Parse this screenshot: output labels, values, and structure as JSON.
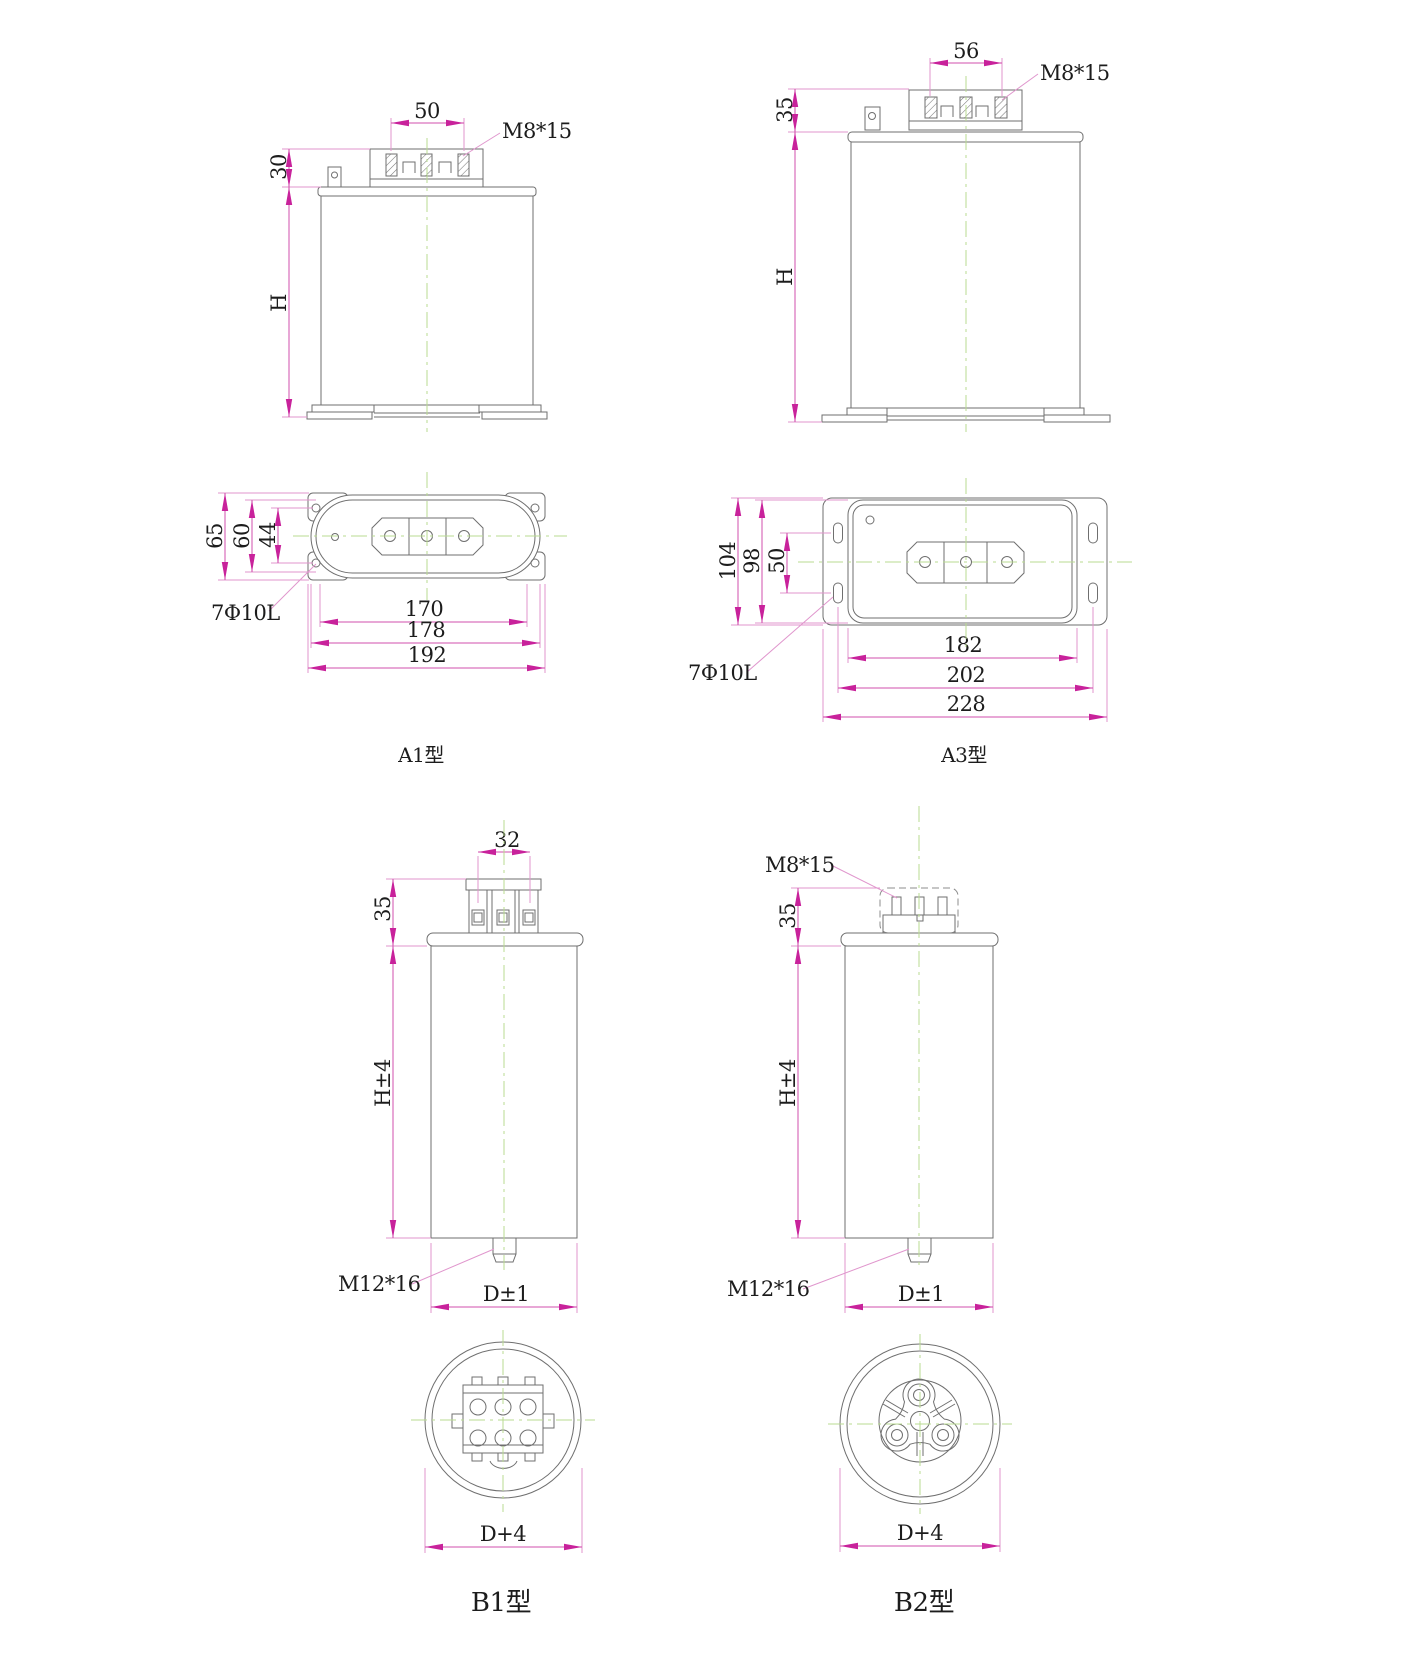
{
  "drawing_title": "Capacitor outline drawings",
  "colors": {
    "dimension_arrow": "#d24fae",
    "dimension_line": "#e096cd",
    "outline": "#6f6f6f",
    "centerline": "#b9db90",
    "text": "#1c1c1c",
    "background": "#ffffff"
  },
  "views": {
    "a1": {
      "label": "A1型",
      "dim_terminal_pitch": "50",
      "thread": "M8*15",
      "dim_terminal_height": "30",
      "dim_body_height": "H",
      "dim_plate_height": "65",
      "dim_inner_height": "60",
      "dim_hole_spacing": "44",
      "holes": "7Φ10L",
      "dim_width_1": "170",
      "dim_width_2": "178",
      "dim_width_3": "192"
    },
    "a3": {
      "label": "A3型",
      "dim_terminal_pitch": "56",
      "thread": "M8*15",
      "dim_terminal_height": "35",
      "dim_body_height": "H",
      "dim_plate_height": "104",
      "dim_inner_height": "98",
      "dim_slot_spacing": "50",
      "holes": "7Φ10L",
      "dim_width_1": "182",
      "dim_width_2": "202",
      "dim_width_3": "228"
    },
    "b1": {
      "label": "B1型",
      "dim_terminal_pitch": "32",
      "dim_terminal_height": "35",
      "dim_body_height": "H±4",
      "stud": "M12*16",
      "dim_diameter": "D±1",
      "dim_outer_diameter": "D+4"
    },
    "b2": {
      "label": "B2型",
      "thread": "M8*15",
      "dim_terminal_height": "35",
      "dim_body_height": "H±4",
      "stud": "M12*16",
      "dim_diameter": "D±1",
      "dim_outer_diameter": "D+4"
    }
  }
}
